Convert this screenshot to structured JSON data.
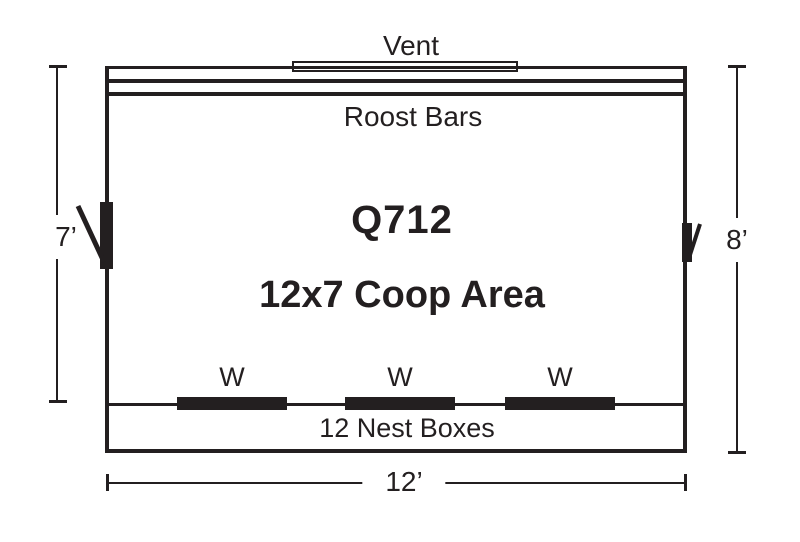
{
  "plan": {
    "model": "Q712",
    "area_label": "12x7 Coop Area",
    "vent_label": "Vent",
    "roost_bars_label": "Roost Bars",
    "nest_boxes_label": "12 Nest Boxes",
    "window_labels": [
      "W",
      "W",
      "W"
    ],
    "dimensions": {
      "left_height": "7’",
      "right_height": "8’",
      "bottom_width": "12’"
    },
    "colors": {
      "ink": "#231f20",
      "paper": "#ffffff"
    }
  }
}
